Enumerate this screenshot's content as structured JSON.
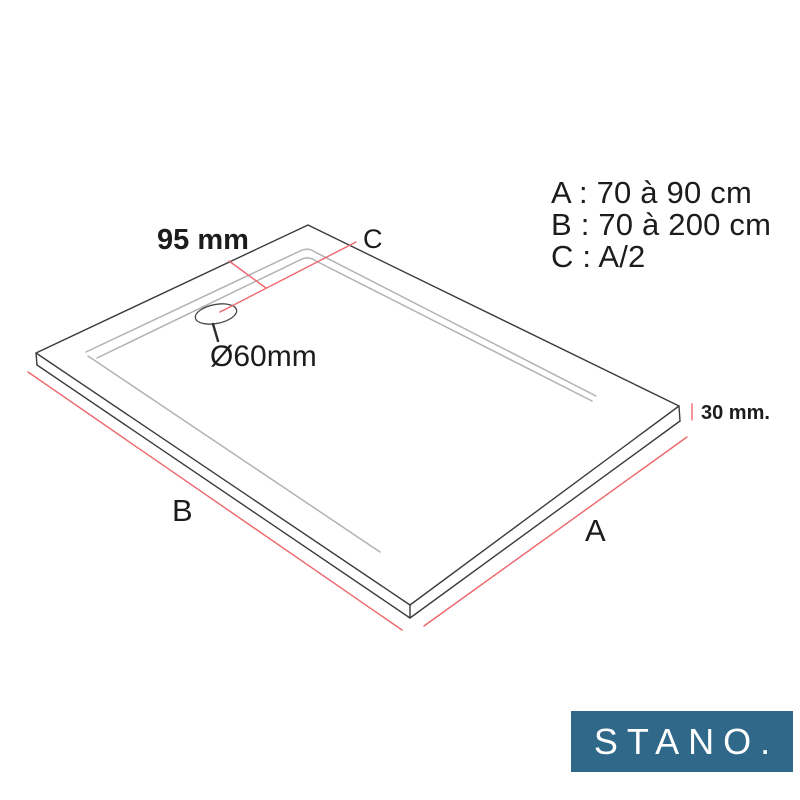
{
  "diagram": {
    "dimension_labels": {
      "top_width": "95 mm",
      "c": "C",
      "drain_diameter": "Ø60mm",
      "thickness": "30 mm.",
      "b": "B",
      "a": "A"
    },
    "legend": {
      "a": "A : 70 à 90 cm",
      "b": "B : 70 à 200 cm",
      "c": "C : A/2"
    }
  },
  "logo": {
    "text": "STANO."
  },
  "colors": {
    "outline": "#3b3b3b",
    "inner_lines": "#b2b2b2",
    "dimension_red": "#ee666b",
    "logo_background": "#30688a",
    "logo_text": "#ffffff",
    "text": "#1c1c1c"
  }
}
